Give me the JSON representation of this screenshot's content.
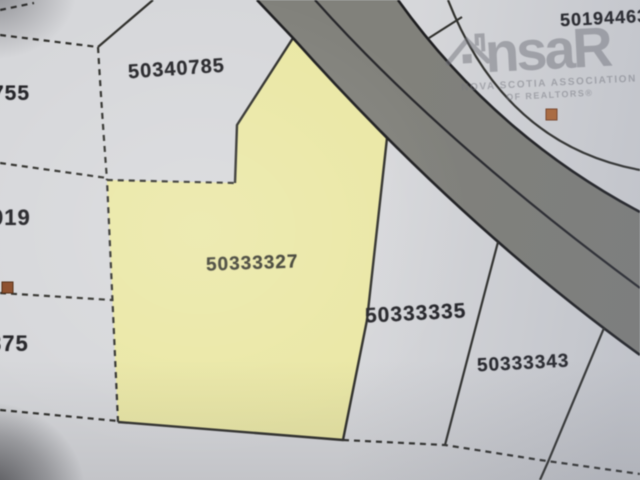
{
  "map": {
    "parcels": {
      "highlighted": {
        "pid": "50333327"
      },
      "upper_left": {
        "pid": "50340785"
      },
      "right": {
        "pid": "50333335"
      },
      "lower_right": {
        "pid": "50333343"
      },
      "top_right": {
        "pid": "50194463"
      },
      "left_top": {
        "pid": "755"
      },
      "left_middle": {
        "pid": "019"
      },
      "left_bottom": {
        "pid": "375"
      }
    },
    "colors": {
      "background": "#d6d7da",
      "highlight_parcel": "#eae7a4",
      "road_fill": "#81817b",
      "road_edge": "#1d1d1f",
      "boundary": "#2e2e2a",
      "marker_left": "#8a4b28",
      "marker_right": "#b26b3a"
    }
  },
  "watermark": {
    "logo_left": "ns",
    "logo_right": "aR",
    "line1": "NOVA SCOTIA ASSOCIATION",
    "line2": "OF REALTORS®"
  }
}
